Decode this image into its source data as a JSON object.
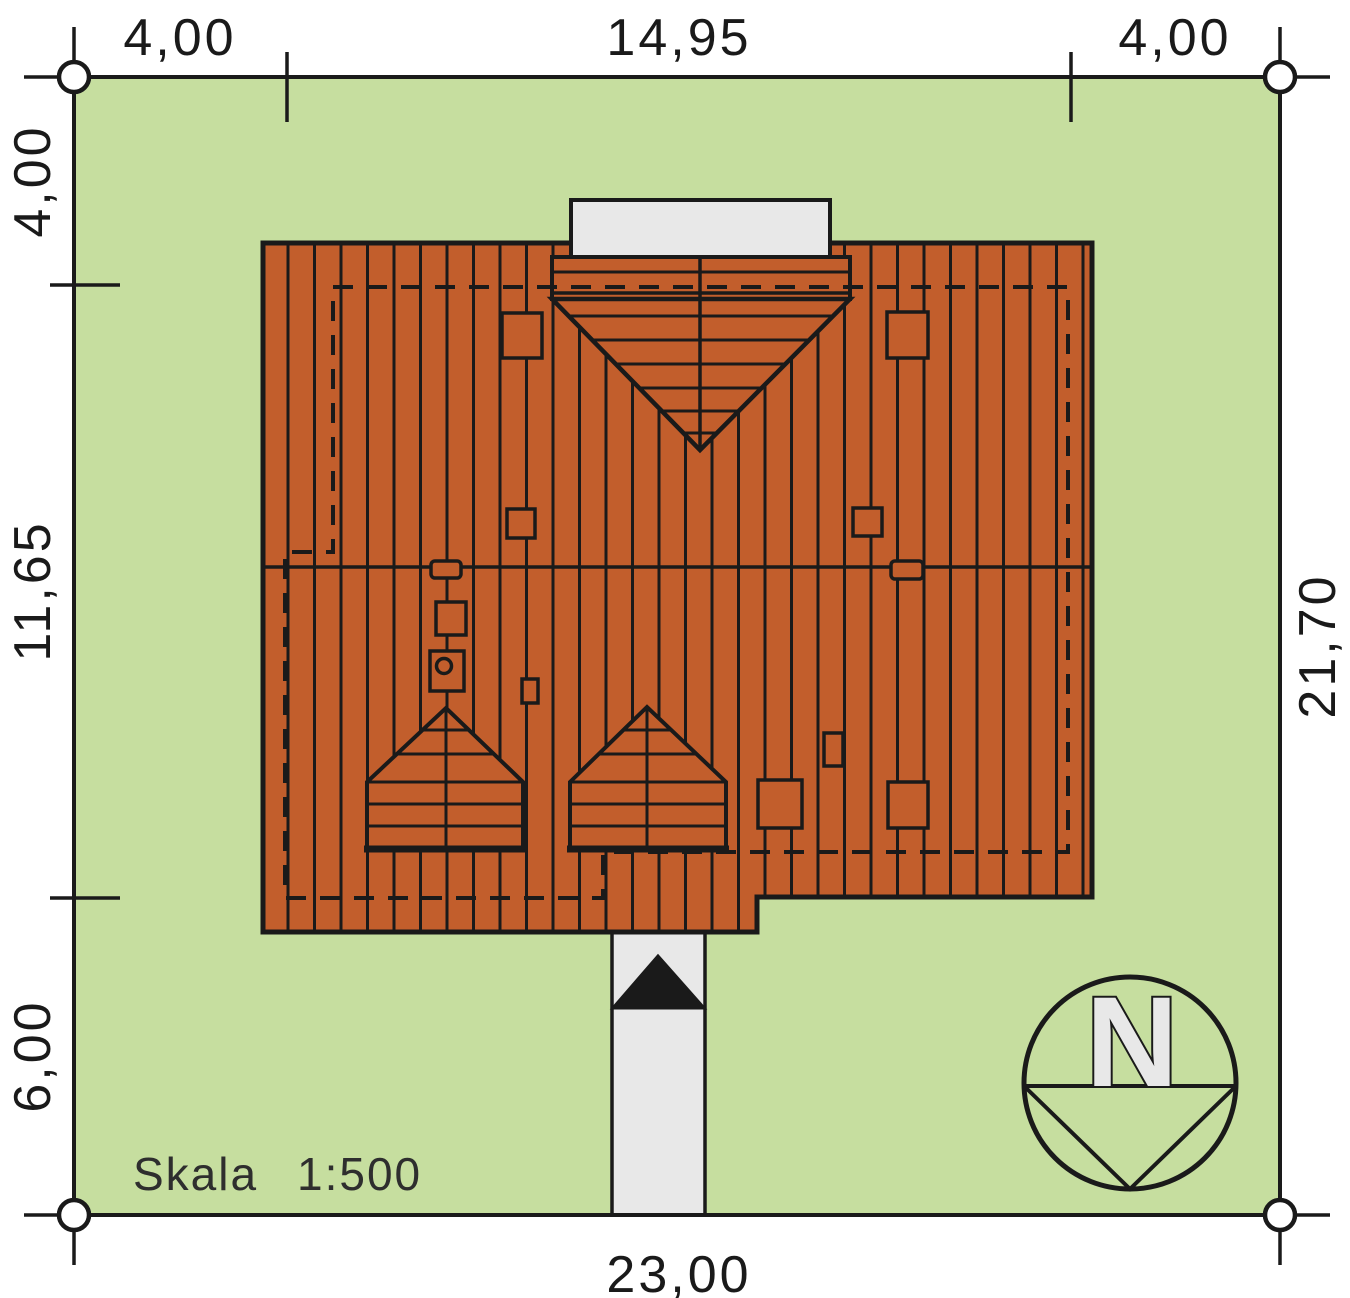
{
  "title": "Site plan with roof view",
  "scale": {
    "label": "Skala",
    "value": "1:500"
  },
  "compass": {
    "letter": "N"
  },
  "dimensions": {
    "top": [
      "4,00",
      "14,95",
      "4,00"
    ],
    "left": [
      "4,00",
      "11,65",
      "6,00"
    ],
    "right": [
      "21,70"
    ],
    "bottom": [
      "23,00"
    ]
  },
  "colors": {
    "plot_green": "#c6de9f",
    "roof_terracotta": "#c25e2c",
    "paving_gray": "#e8e8e8",
    "line_black": "#1a1a1a"
  }
}
